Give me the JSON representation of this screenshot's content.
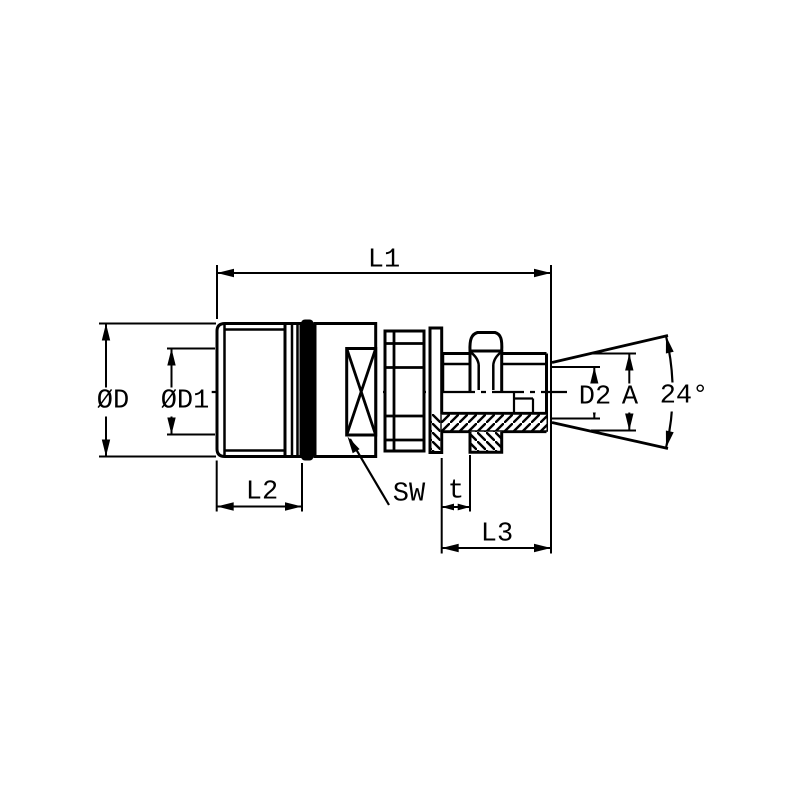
{
  "drawing": {
    "type": "technical-dimension-drawing",
    "subject": "hydraulic quick-release screw coupling, male stud with 24-degree cone",
    "background_color": "#ffffff",
    "line_color": "#000000",
    "labels": {
      "l1": "L1",
      "l2": "L2",
      "l3": "L3",
      "od": "ØD",
      "od1": "ØD1",
      "d2": "D2",
      "a": "A",
      "sw": "SW",
      "t": "t",
      "angle": "24°"
    }
  }
}
